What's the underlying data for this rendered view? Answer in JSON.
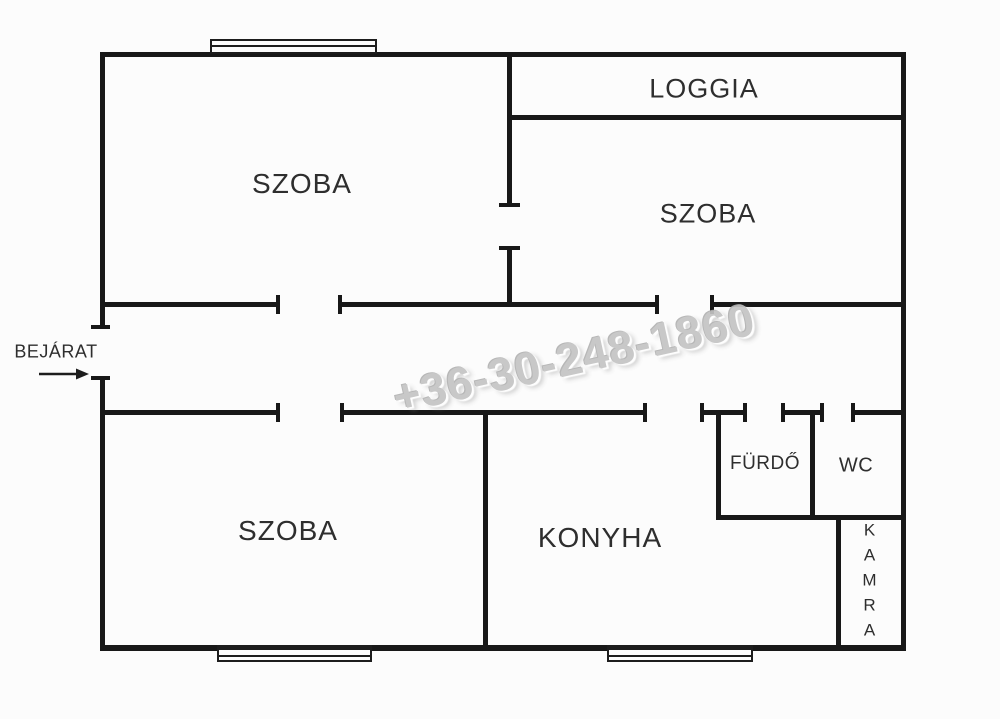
{
  "rooms": {
    "room_top_left": "SZOBA",
    "loggia": "LOGGIA",
    "room_top_right": "SZOBA",
    "room_bottom_left": "SZOBA",
    "kitchen": "KONYHA",
    "bathroom": "FÜRDŐ",
    "wc": "WC",
    "pantry": "KAMRA"
  },
  "entrance": {
    "label": "BEJÁRAT"
  },
  "watermark": "+36-30-248-1860",
  "icons": {
    "entrance_arrow": "right-arrow"
  },
  "colors": {
    "wall": "#181818",
    "label": "#2e2e2e",
    "watermark": "#c4c4c4",
    "background": "#fcfcfc"
  }
}
